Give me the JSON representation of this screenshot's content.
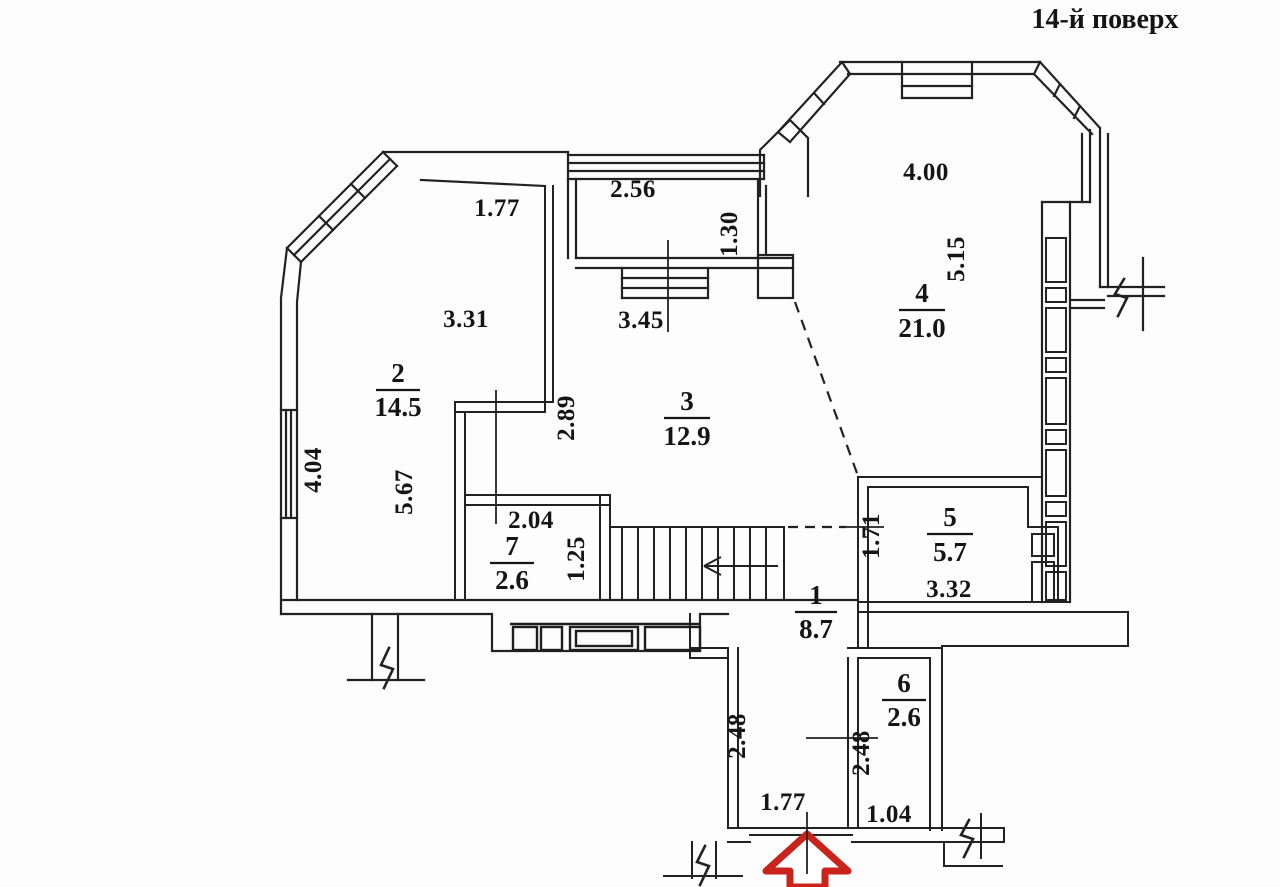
{
  "meta": {
    "floor_title": "14-й поверх"
  },
  "colors": {
    "ink": "#1e1e1e",
    "entrance_arrow_red": "#c9241c",
    "paper": "#fdfdfd"
  },
  "rooms": [
    {
      "number": "1",
      "area": "8.7"
    },
    {
      "number": "2",
      "area": "14.5"
    },
    {
      "number": "3",
      "area": "12.9"
    },
    {
      "number": "4",
      "area": "21.0"
    },
    {
      "number": "5",
      "area": "5.7"
    },
    {
      "number": "6",
      "area": "2.6"
    },
    {
      "number": "7",
      "area": "2.6"
    }
  ],
  "dimensions": {
    "room2_top": "1.77",
    "room2_width": "3.31",
    "left_window": "4.04",
    "room2_depth": "5.67",
    "balcony_width": "2.56",
    "balcony_window": "3.45",
    "balcony_depth": "1.30",
    "room3_width": "2.89",
    "room4_width": "4.00",
    "room4_depth": "5.15",
    "room5_depth": "1.71",
    "room5_width": "3.32",
    "room7_width": "2.04",
    "room7_depth": "1.25",
    "hall_depth": "2.48",
    "entry_width": "1.77",
    "room6_depth": "2.48",
    "room6_width": "1.04"
  }
}
